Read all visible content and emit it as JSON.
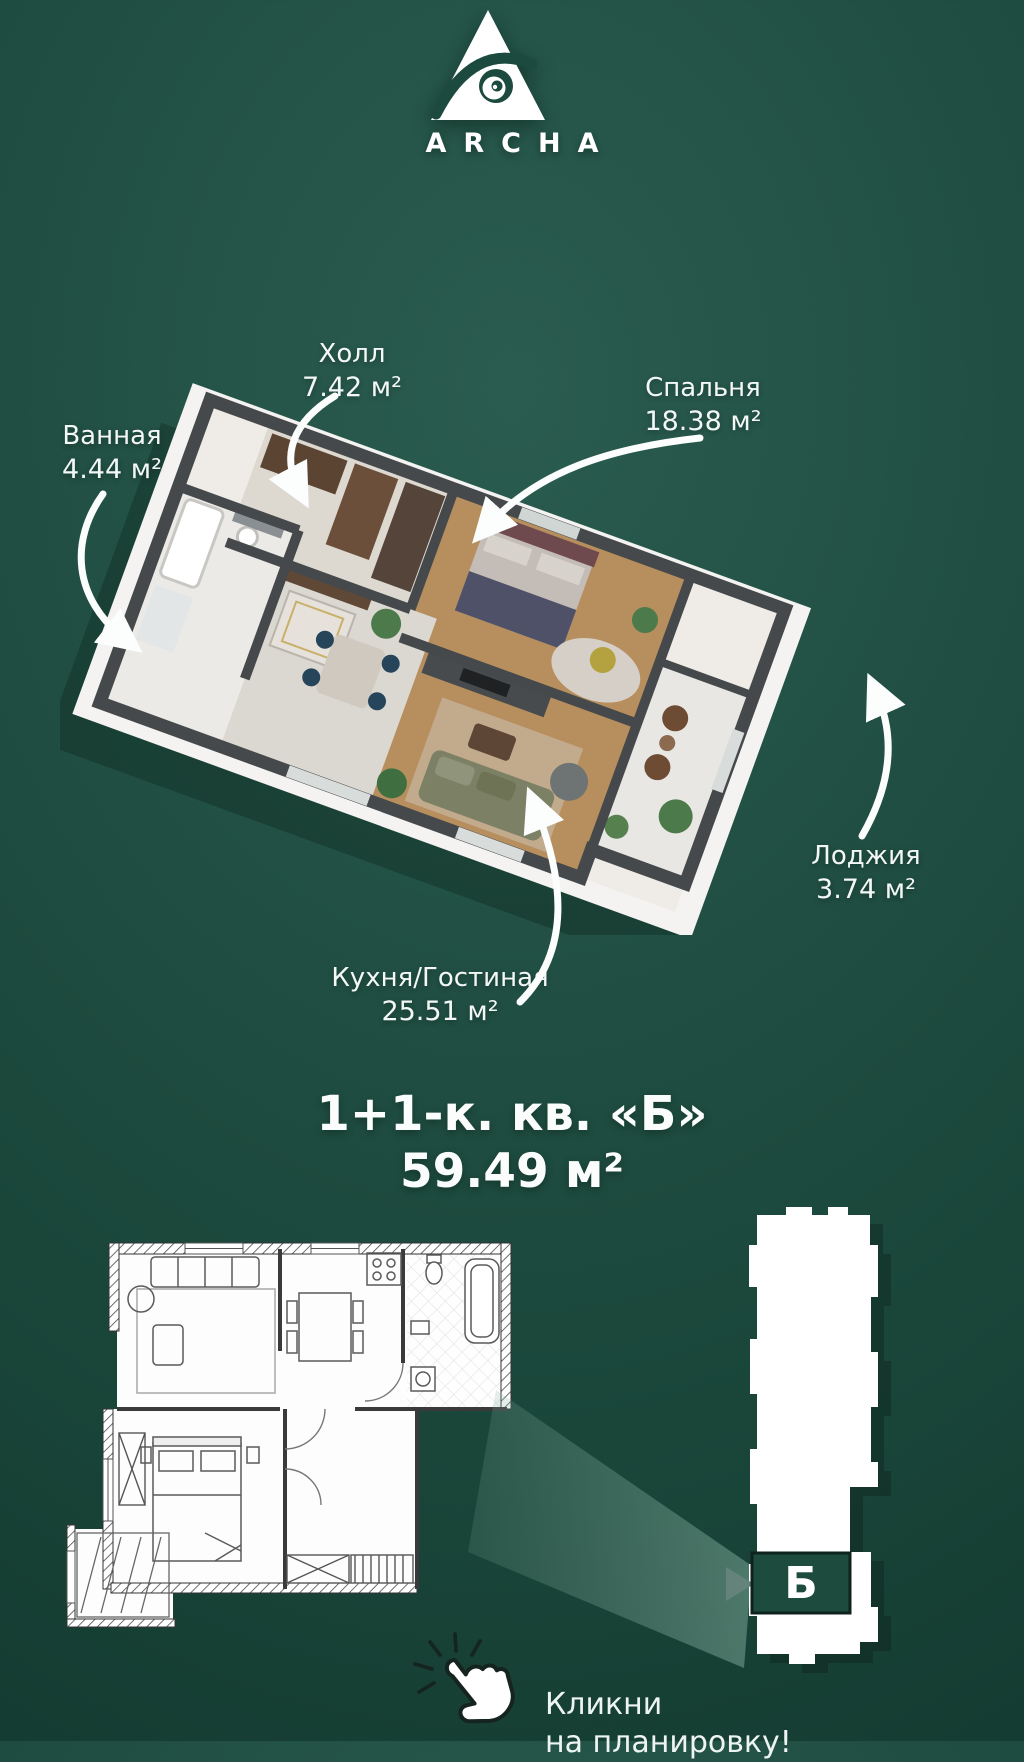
{
  "brand": {
    "name": "ARCHA"
  },
  "plan3d": {
    "rooms": [
      {
        "name": "Холл",
        "area": "7.42 м²"
      },
      {
        "name": "Спальня",
        "area": "18.38 м²"
      },
      {
        "name": "Ванная",
        "area": "4.44 м²"
      },
      {
        "name": "Кухня/Гостиная",
        "area": "25.51 м²"
      },
      {
        "name": "Лоджия",
        "area": "3.74 м²"
      }
    ]
  },
  "title": {
    "line1": "1+1-к. кв. «Б»",
    "line2": "59.49 м²"
  },
  "building": {
    "unit_label": "Б"
  },
  "cta": {
    "line1": "Кликни",
    "line2": "на планировку!"
  },
  "colors": {
    "background": "#1d4a3e",
    "beam": "#7daa9a",
    "wall_dark": "#45494b",
    "slab_white": "#f4f3f1",
    "text": "#ffffff"
  }
}
